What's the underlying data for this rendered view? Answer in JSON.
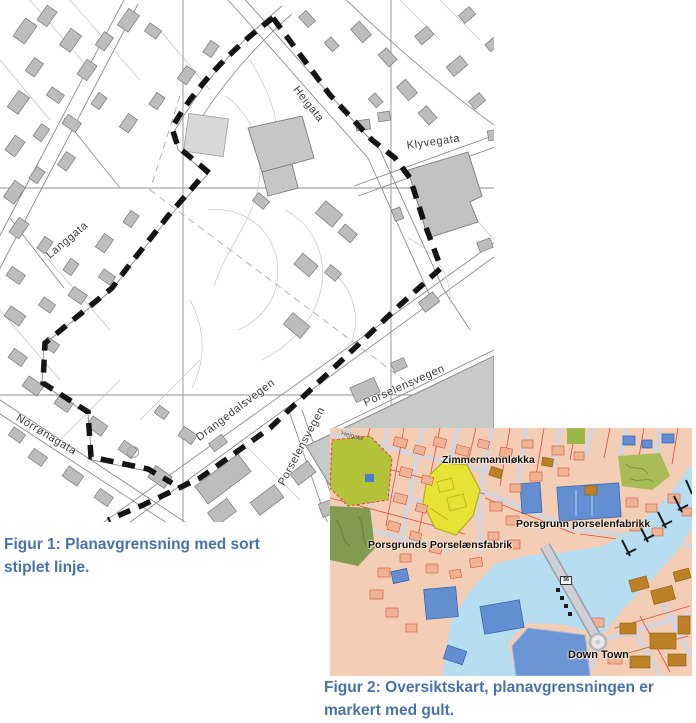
{
  "document": {
    "type": "planning-document-figures",
    "caption_color": "#4673ac"
  },
  "captions": {
    "figure1": "Figur 1: Planavgrensning med sort stiplet linje.",
    "figure2": "Figur 2: Oversiktskart, planavgrensningen er markert med gult."
  },
  "map1": {
    "description": "Black/white cadastral map with plan boundary as thick black dashed line",
    "street_labels": {
      "heigata": "Heigata",
      "klyvegata": "Klyvegata",
      "langgata": "Langgata",
      "norronagata": "Norrønagata",
      "drangedalsvegen": "Drangedalsvegen",
      "porselensvegen_upper": "Porselensvegen",
      "porselensvegen_lower": "Porselensvegen"
    },
    "colors": {
      "background": "#ffffff",
      "building": "#bdbdbd",
      "street_line": "#8c8c8c",
      "boundary": "#141414",
      "industrial_area": "#c9c9c9"
    }
  },
  "map2": {
    "description": "Coloured town map, plan area highlighted in yellow",
    "labels": {
      "zimmermannlokka": "Zimmermannløkka",
      "porsgrunn_porselenfabrikk": "Porsgrunn porselenfabrikk",
      "porsgrunds_porselansfabrik": "Porsgrunds Porselænsfabrik",
      "down_town": "Down Town",
      "heigata": "Heigata",
      "road_badge": "36"
    },
    "colors": {
      "water": "#b7def0",
      "land": "#f3cdb4",
      "plan_highlight": "#e6e335",
      "park": "#b3c339",
      "blue_building": "#638fd2",
      "mustard_building": "#bc8026",
      "salmon_building": "#efb393",
      "red_parcel_line": "#d85040",
      "street": "#d4d4da"
    }
  }
}
